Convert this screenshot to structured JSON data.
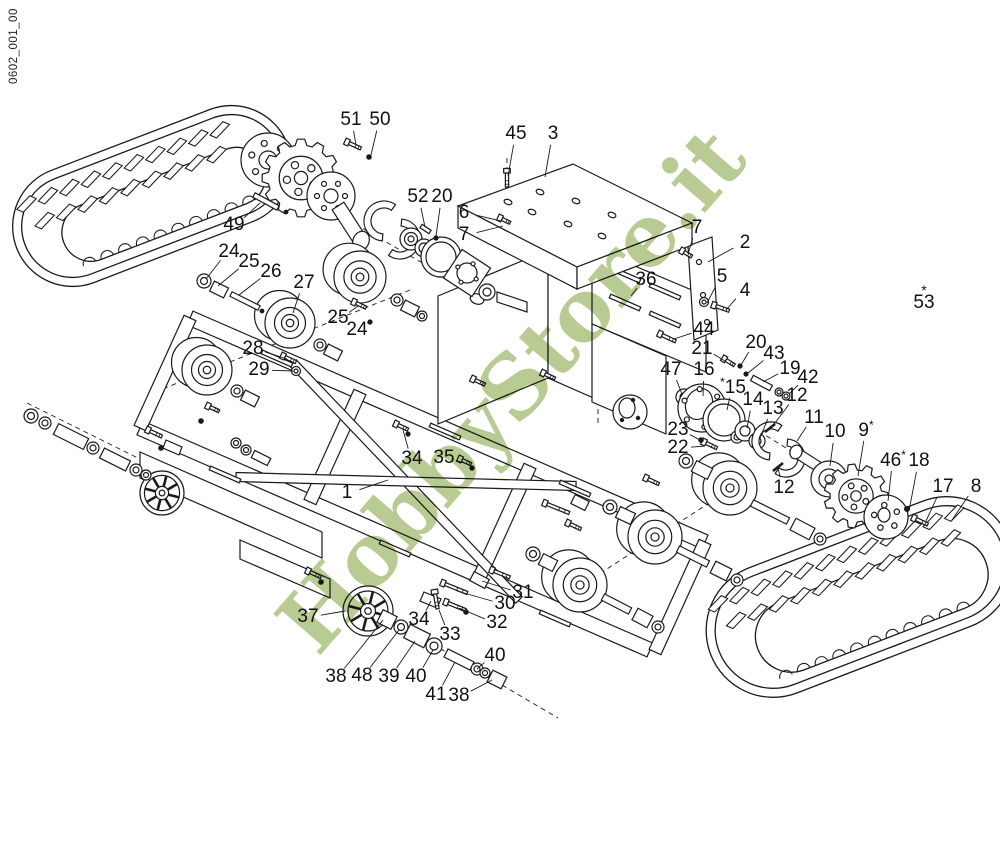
{
  "doc_code": "0602_001_00",
  "watermark": {
    "text": "HobbyStore.it",
    "color": "#b7cb92"
  },
  "diagram_colors": {
    "line": "#1a1a1a",
    "background": "#ffffff"
  },
  "callouts": [
    {
      "n": "51",
      "x": 351,
      "y": 120,
      "lx": 356,
      "ly": 145
    },
    {
      "n": "50",
      "x": 380,
      "y": 120,
      "lx": 371,
      "ly": 155
    },
    {
      "n": "45",
      "x": 516,
      "y": 134,
      "lx": 508,
      "ly": 176
    },
    {
      "n": "3",
      "x": 553,
      "y": 134,
      "lx": 545,
      "ly": 177
    },
    {
      "n": "52",
      "x": 418,
      "y": 197,
      "lx": 425,
      "ly": 227
    },
    {
      "n": "20",
      "x": 442,
      "y": 197,
      "lx": 436,
      "ly": 236
    },
    {
      "n": "49",
      "x": 234,
      "y": 225,
      "lx": 260,
      "ly": 203
    },
    {
      "n": "6",
      "x": 464,
      "y": 213,
      "lx": 501,
      "ly": 221
    },
    {
      "n": "7",
      "x": 464,
      "y": 235,
      "lx": 503,
      "ly": 226
    },
    {
      "n": "24",
      "x": 229,
      "y": 252,
      "lx": 206,
      "ly": 279
    },
    {
      "n": "25",
      "x": 249,
      "y": 262,
      "lx": 218,
      "ly": 286
    },
    {
      "n": "26",
      "x": 271,
      "y": 272,
      "lx": 239,
      "ly": 295
    },
    {
      "n": "27",
      "x": 304,
      "y": 283,
      "lx": 293,
      "ly": 313
    },
    {
      "n": "7",
      "x": 697,
      "y": 228,
      "lx": 688,
      "ly": 254
    },
    {
      "n": "2",
      "x": 745,
      "y": 243,
      "lx": 708,
      "ly": 262
    },
    {
      "n": "36",
      "x": 646,
      "y": 280,
      "lx": 631,
      "ly": 296
    },
    {
      "n": "5",
      "x": 722,
      "y": 277,
      "lx": 707,
      "ly": 303
    },
    {
      "n": "4",
      "x": 745,
      "y": 291,
      "lx": 726,
      "ly": 310
    },
    {
      "n": "53",
      "x": 924,
      "y": 300,
      "star": "above"
    },
    {
      "n": "44",
      "x": 704,
      "y": 330,
      "lx": 674,
      "ly": 339
    },
    {
      "n": "21",
      "x": 702,
      "y": 349,
      "lx": 725,
      "ly": 361
    },
    {
      "n": "20",
      "x": 756,
      "y": 343,
      "lx": 741,
      "ly": 365
    },
    {
      "n": "43",
      "x": 774,
      "y": 354,
      "lx": 748,
      "ly": 373
    },
    {
      "n": "19",
      "x": 790,
      "y": 369,
      "lx": 763,
      "ly": 382
    },
    {
      "n": "42",
      "x": 808,
      "y": 378,
      "lx": 789,
      "ly": 394
    },
    {
      "n": "25",
      "x": 338,
      "y": 318,
      "lx": 358,
      "ly": 306
    },
    {
      "n": "24",
      "x": 357,
      "y": 330,
      "lx": 368,
      "ly": 322
    },
    {
      "n": "28",
      "x": 253,
      "y": 349,
      "lx": 287,
      "ly": 359
    },
    {
      "n": "29",
      "x": 259,
      "y": 370,
      "lx": 293,
      "ly": 371
    },
    {
      "n": "47",
      "x": 671,
      "y": 370,
      "lx": 682,
      "ly": 394
    },
    {
      "n": "16",
      "x": 704,
      "y": 370,
      "lx": 703,
      "ly": 396
    },
    {
      "n": "15",
      "x": 733,
      "y": 387,
      "star": "left",
      "lx": 727,
      "ly": 410
    },
    {
      "n": "14",
      "x": 753,
      "y": 400,
      "lx": 747,
      "ly": 428
    },
    {
      "n": "13",
      "x": 773,
      "y": 409,
      "lx": 760,
      "ly": 438
    },
    {
      "n": "12",
      "x": 797,
      "y": 396,
      "lx": 772,
      "ly": 427
    },
    {
      "n": "23",
      "x": 678,
      "y": 430,
      "lx": 700,
      "ly": 440
    },
    {
      "n": "22",
      "x": 678,
      "y": 448,
      "lx": 704,
      "ly": 446
    },
    {
      "n": "11",
      "x": 814,
      "y": 418,
      "lx": 797,
      "ly": 441
    },
    {
      "n": "10",
      "x": 835,
      "y": 432,
      "lx": 830,
      "ly": 466
    },
    {
      "n": "9",
      "x": 866,
      "y": 430,
      "star": "right",
      "lx": 858,
      "ly": 476
    },
    {
      "n": "46",
      "x": 893,
      "y": 460,
      "star": "right",
      "lx": 888,
      "ly": 501
    },
    {
      "n": "18",
      "x": 919,
      "y": 461,
      "lx": 909,
      "ly": 511
    },
    {
      "n": "17",
      "x": 943,
      "y": 487,
      "lx": 926,
      "ly": 521
    },
    {
      "n": "8",
      "x": 976,
      "y": 487,
      "lx": 952,
      "ly": 520
    },
    {
      "n": "12",
      "x": 784,
      "y": 488,
      "lx": 778,
      "ly": 468
    },
    {
      "n": "1",
      "x": 347,
      "y": 493,
      "lx": 388,
      "ly": 480
    },
    {
      "n": "34",
      "x": 412,
      "y": 459,
      "lx": 403,
      "ly": 430
    },
    {
      "n": "35",
      "x": 444,
      "y": 458,
      "lx": 464,
      "ly": 463
    },
    {
      "n": "31",
      "x": 523,
      "y": 593,
      "lx": 482,
      "ly": 581
    },
    {
      "n": "30",
      "x": 505,
      "y": 604,
      "lx": 457,
      "ly": 591
    },
    {
      "n": "32",
      "x": 497,
      "y": 623,
      "lx": 459,
      "ly": 608
    },
    {
      "n": "33",
      "x": 450,
      "y": 635,
      "lx": 439,
      "ly": 610
    },
    {
      "n": "34",
      "x": 419,
      "y": 620,
      "lx": 431,
      "ly": 601
    },
    {
      "n": "37",
      "x": 308,
      "y": 617,
      "lx": 345,
      "ly": 611
    },
    {
      "n": "38",
      "x": 336,
      "y": 677,
      "lx": 383,
      "ly": 620
    },
    {
      "n": "48",
      "x": 362,
      "y": 676,
      "lx": 399,
      "ly": 630
    },
    {
      "n": "39",
      "x": 389,
      "y": 677,
      "lx": 415,
      "ly": 641
    },
    {
      "n": "40",
      "x": 416,
      "y": 677,
      "lx": 433,
      "ly": 650
    },
    {
      "n": "41",
      "x": 436,
      "y": 695,
      "lx": 455,
      "ly": 662
    },
    {
      "n": "38",
      "x": 459,
      "y": 696,
      "lx": 492,
      "ly": 680
    },
    {
      "n": "40",
      "x": 495,
      "y": 656,
      "lx": 477,
      "ly": 669
    }
  ]
}
